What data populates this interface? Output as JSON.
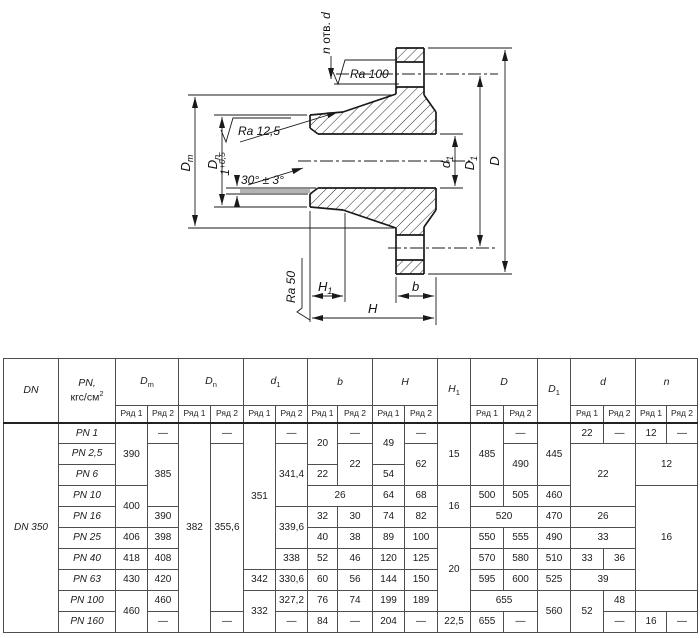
{
  "drawing": {
    "labels": {
      "holes_prefix": "n",
      "holes_mid": " отв. ",
      "holes_suffix": "d",
      "ra_top": "Ra 100",
      "ra_taper": "Ra 12,5",
      "ra_face": "Ra 50",
      "chamfer_angle": "30° ± 3°",
      "land_value": "1",
      "land_tol": "+0,5",
      "dim_dm_letter": "D",
      "dim_dm_sub": "m",
      "dim_dn_letter": "D",
      "dim_dn_sub": "n",
      "dim_d1_letter": "d",
      "dim_d1_sub": "1",
      "dim_D1_letter": "D",
      "dim_D1_sub": "1",
      "dim_D": "D",
      "dim_H": "H",
      "dim_H1_letter": "H",
      "dim_H1_sub": "1",
      "dim_b": "b"
    }
  },
  "table": {
    "col_widths": [
      55,
      57,
      32,
      31,
      32,
      33,
      32,
      32,
      30,
      35,
      32,
      33,
      33,
      33,
      34,
      33,
      33,
      32,
      31,
      31
    ],
    "head": [
      [
        {
          "p": [
            {
              "t": "DN",
              "st": "i"
            }
          ],
          "rs": 2,
          "c": "hl"
        },
        {
          "p": [
            {
              "t": "PN,",
              "st": "i"
            },
            {
              "st": "br"
            },
            {
              "t": "кгс/см"
            },
            {
              "t": "2",
              "st": "S"
            }
          ],
          "rs": 2,
          "c": "hl"
        },
        {
          "p": [
            {
              "t": "D",
              "st": "i"
            },
            {
              "t": "m",
              "st": "s"
            }
          ],
          "cs": 2,
          "c": "hl"
        },
        {
          "p": [
            {
              "t": "D",
              "st": "i"
            },
            {
              "t": "n",
              "st": "s"
            }
          ],
          "cs": 2,
          "c": "hl"
        },
        {
          "p": [
            {
              "t": "d",
              "st": "i"
            },
            {
              "t": "1",
              "st": "s"
            }
          ],
          "cs": 2,
          "c": "hl"
        },
        {
          "p": [
            {
              "t": "b",
              "st": "i"
            }
          ],
          "cs": 2,
          "c": "hl"
        },
        {
          "p": [
            {
              "t": "H",
              "st": "i"
            }
          ],
          "cs": 2,
          "c": "hl"
        },
        {
          "p": [
            {
              "t": "H",
              "st": "i"
            },
            {
              "t": "1",
              "st": "s"
            }
          ],
          "rs": 2,
          "c": "hl"
        },
        {
          "p": [
            {
              "t": "D",
              "st": "i"
            }
          ],
          "cs": 2,
          "c": "hl"
        },
        {
          "p": [
            {
              "t": "D",
              "st": "i"
            },
            {
              "t": "1",
              "st": "s"
            }
          ],
          "rs": 2,
          "c": "hl"
        },
        {
          "p": [
            {
              "t": "d",
              "st": "i"
            }
          ],
          "cs": 2,
          "c": "hl"
        },
        {
          "p": [
            {
              "t": "n",
              "st": "i"
            }
          ],
          "cs": 2,
          "c": "hl"
        }
      ],
      [
        {
          "v": "Ряд 1",
          "c": "ryad"
        },
        {
          "v": "Ряд 2",
          "c": "ryad"
        },
        {
          "v": "Ряд 1",
          "c": "ryad"
        },
        {
          "v": "Ряд 2",
          "c": "ryad"
        },
        {
          "v": "Ряд 1",
          "c": "ryad"
        },
        {
          "v": "Ряд 2",
          "c": "ryad"
        },
        {
          "v": "Ряд 1",
          "c": "ryad"
        },
        {
          "v": "Ряд 2",
          "c": "ryad"
        },
        {
          "v": "Ряд 1",
          "c": "ryad"
        },
        {
          "v": "Ряд 2",
          "c": "ryad"
        },
        {
          "v": "Ряд 1",
          "c": "ryad"
        },
        {
          "v": "Ряд 2",
          "c": "ryad"
        },
        {
          "v": "Ряд 1",
          "c": "ryad"
        },
        {
          "v": "Ряд 2",
          "c": "ryad"
        },
        {
          "v": "Ряд 1",
          "c": "ryad"
        },
        {
          "v": "Ряд 2",
          "c": "ryad"
        }
      ]
    ],
    "rows": [
      [
        {
          "v": "DN 350",
          "rs": 10,
          "i": 1
        },
        {
          "v": "PN 1",
          "i": 1
        },
        {
          "v": "390",
          "rs": 3
        },
        {
          "v": "—"
        },
        {
          "v": "382",
          "rs": 10
        },
        {
          "v": "—"
        },
        {
          "v": "351",
          "rs": 7
        },
        {
          "v": "—"
        },
        {
          "v": "20",
          "rs": 2
        },
        {
          "v": "—"
        },
        {
          "v": "49",
          "rs": 2
        },
        {
          "v": "—"
        },
        {
          "v": "15",
          "rs": 3
        },
        {
          "v": "485",
          "rs": 3
        },
        {
          "v": "—"
        },
        {
          "v": "445",
          "rs": 3
        },
        {
          "v": "22"
        },
        {
          "v": "—"
        },
        {
          "v": "12"
        },
        {
          "v": "—"
        }
      ],
      [
        {
          "v": "PN 2,5",
          "i": 1
        },
        {
          "v": "385",
          "rs": 3
        },
        {
          "v": "355,6",
          "rs": 8
        },
        {
          "v": "341,4",
          "rs": 3
        },
        {
          "v": "22",
          "rs": 2
        },
        {
          "v": "62",
          "rs": 2
        },
        {
          "v": "490",
          "rs": 2
        },
        {
          "v": "22",
          "rs": 3,
          "cs": 2
        },
        {
          "v": "12",
          "rs": 2,
          "cs": 2
        }
      ],
      [
        {
          "v": "PN 6",
          "i": 1
        },
        {
          "v": "22"
        },
        {
          "v": "54"
        }
      ],
      [
        {
          "v": "PN 10",
          "i": 1
        },
        {
          "v": "400",
          "rs": 2
        },
        {
          "v": "26",
          "cs": 2
        },
        {
          "v": "64"
        },
        {
          "v": "68"
        },
        {
          "v": "16",
          "rs": 2
        },
        {
          "v": "500"
        },
        {
          "v": "505"
        },
        {
          "v": "460"
        },
        {
          "v": "16",
          "rs": 5,
          "cs": 2
        }
      ],
      [
        {
          "v": "PN 16",
          "i": 1
        },
        {
          "v": "390"
        },
        {
          "v": "339,6",
          "rs": 2
        },
        {
          "v": "32"
        },
        {
          "v": "30"
        },
        {
          "v": "74"
        },
        {
          "v": "82"
        },
        {
          "v": "520",
          "cs": 2
        },
        {
          "v": "470"
        },
        {
          "v": "26",
          "cs": 2
        }
      ],
      [
        {
          "v": "PN 25",
          "i": 1
        },
        {
          "v": "406"
        },
        {
          "v": "398"
        },
        {
          "v": "40"
        },
        {
          "v": "38"
        },
        {
          "v": "89"
        },
        {
          "v": "100"
        },
        {
          "v": "20",
          "rs": 4
        },
        {
          "v": "550"
        },
        {
          "v": "555"
        },
        {
          "v": "490"
        },
        {
          "v": "33",
          "cs": 2
        }
      ],
      [
        {
          "v": "PN 40",
          "i": 1
        },
        {
          "v": "418"
        },
        {
          "v": "408"
        },
        {
          "v": "338"
        },
        {
          "v": "52"
        },
        {
          "v": "46"
        },
        {
          "v": "120"
        },
        {
          "v": "125"
        },
        {
          "v": "570"
        },
        {
          "v": "580"
        },
        {
          "v": "510"
        },
        {
          "v": "33"
        },
        {
          "v": "36"
        }
      ],
      [
        {
          "v": "PN 63",
          "i": 1
        },
        {
          "v": "430"
        },
        {
          "v": "420"
        },
        {
          "v": "342"
        },
        {
          "v": "330,6"
        },
        {
          "v": "60"
        },
        {
          "v": "56"
        },
        {
          "v": "144"
        },
        {
          "v": "150"
        },
        {
          "v": "595"
        },
        {
          "v": "600"
        },
        {
          "v": "525"
        },
        {
          "v": "39",
          "cs": 2
        }
      ],
      [
        {
          "v": "PN 100",
          "i": 1
        },
        {
          "v": "460",
          "rs": 2
        },
        {
          "v": "460"
        },
        {
          "v": "332",
          "rs": 2
        },
        {
          "v": "327,2"
        },
        {
          "v": "76"
        },
        {
          "v": "74"
        },
        {
          "v": "199"
        },
        {
          "v": "189"
        },
        {
          "v": "655",
          "cs": 2
        },
        {
          "v": "560",
          "rs": 2
        },
        {
          "v": "52",
          "rs": 2
        },
        {
          "v": "48"
        }
      ],
      [
        {
          "v": "PN 160",
          "i": 1
        },
        {
          "v": "—"
        },
        {
          "v": "—"
        },
        {
          "v": "—"
        },
        {
          "v": "84"
        },
        {
          "v": "—"
        },
        {
          "v": "204"
        },
        {
          "v": "—"
        },
        {
          "v": "22,5"
        },
        {
          "v": "655"
        },
        {
          "v": "—"
        },
        {
          "v": "—"
        },
        {
          "v": "16"
        },
        {
          "v": "—"
        }
      ]
    ]
  }
}
